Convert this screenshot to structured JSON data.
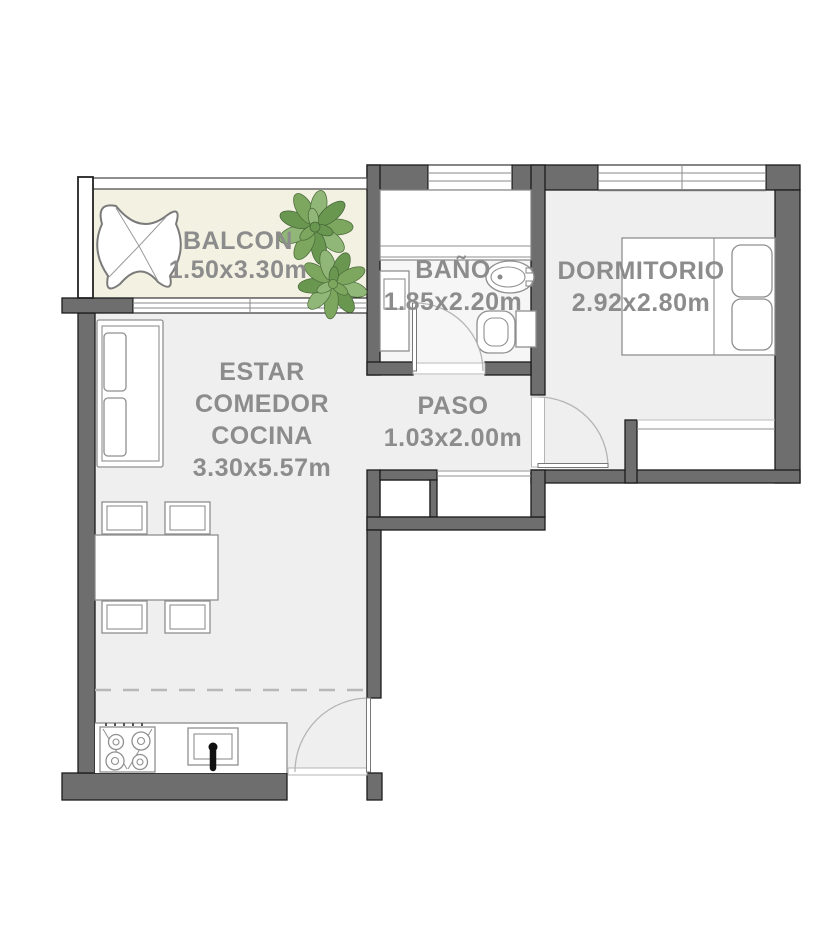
{
  "plan": {
    "rooms": {
      "balcon": {
        "name": "BALCON",
        "dims": "1.50x3.30m"
      },
      "estar_comedor_cocina": {
        "lines": [
          "ESTAR",
          "COMEDOR",
          "COCINA"
        ],
        "dims": "3.30x5.57m"
      },
      "bano": {
        "name": "BAÑO",
        "dims": "1.85x2.20m"
      },
      "dormitorio": {
        "name": "DORMITORIO",
        "dims": "2.92x2.80m"
      },
      "paso": {
        "name": "PASO",
        "dims": "1.03x2.00m"
      }
    },
    "colors": {
      "wall": "#6e6e6e",
      "floor": "#efefef",
      "balcony_floor": "#f3f1e2",
      "bathroom_floor": "#f6f6f6",
      "label_text": "#8c8c8c",
      "plant_green": "#7da65e"
    }
  }
}
